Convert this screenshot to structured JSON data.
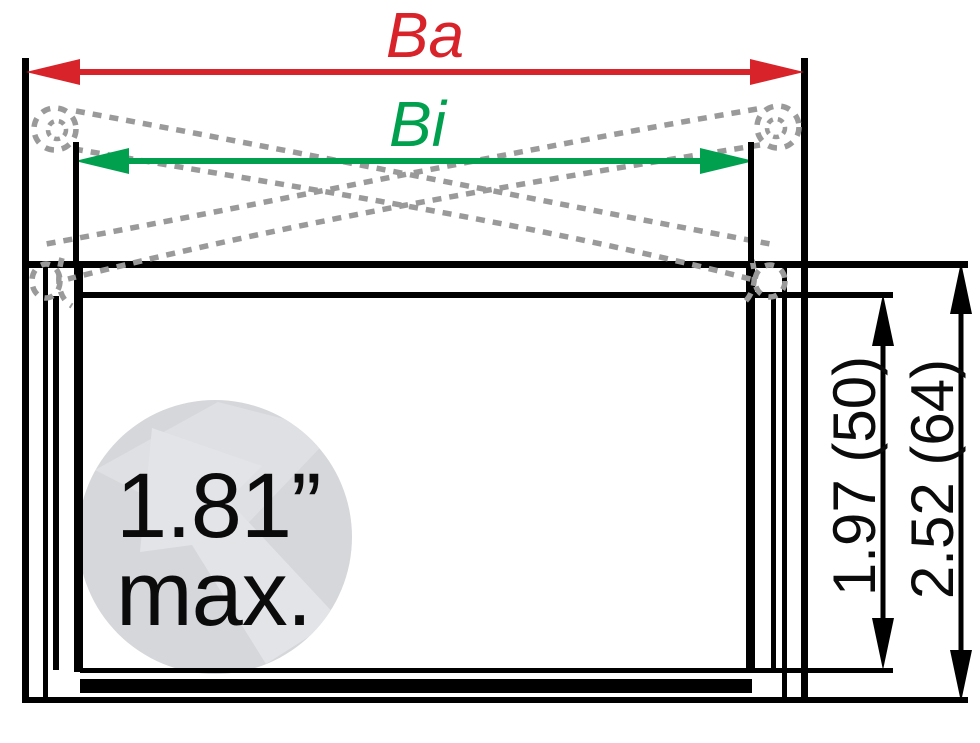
{
  "title": "Drawer slide cross-section dimension diagram",
  "dimensions": {
    "outer_width_label": "Ba",
    "inner_width_label": "Bi",
    "inner_height_label": "1.97 (50)",
    "outer_height_label": "2.52 (64)",
    "max_note": "1.81”\nmax."
  },
  "icons": {
    "cable_left": "dashed-cable-loop",
    "cable_right": "dashed-cable-loop",
    "watermark": "arrow-watermark-circle"
  },
  "colors": {
    "ba_red": "#d8232a",
    "bi_green": "#00a04f",
    "cable_gray": "#9a9a9a",
    "line_black": "#000000",
    "watermark_circle": "#d6d7da",
    "watermark_arrow": "#e3e4e7"
  }
}
